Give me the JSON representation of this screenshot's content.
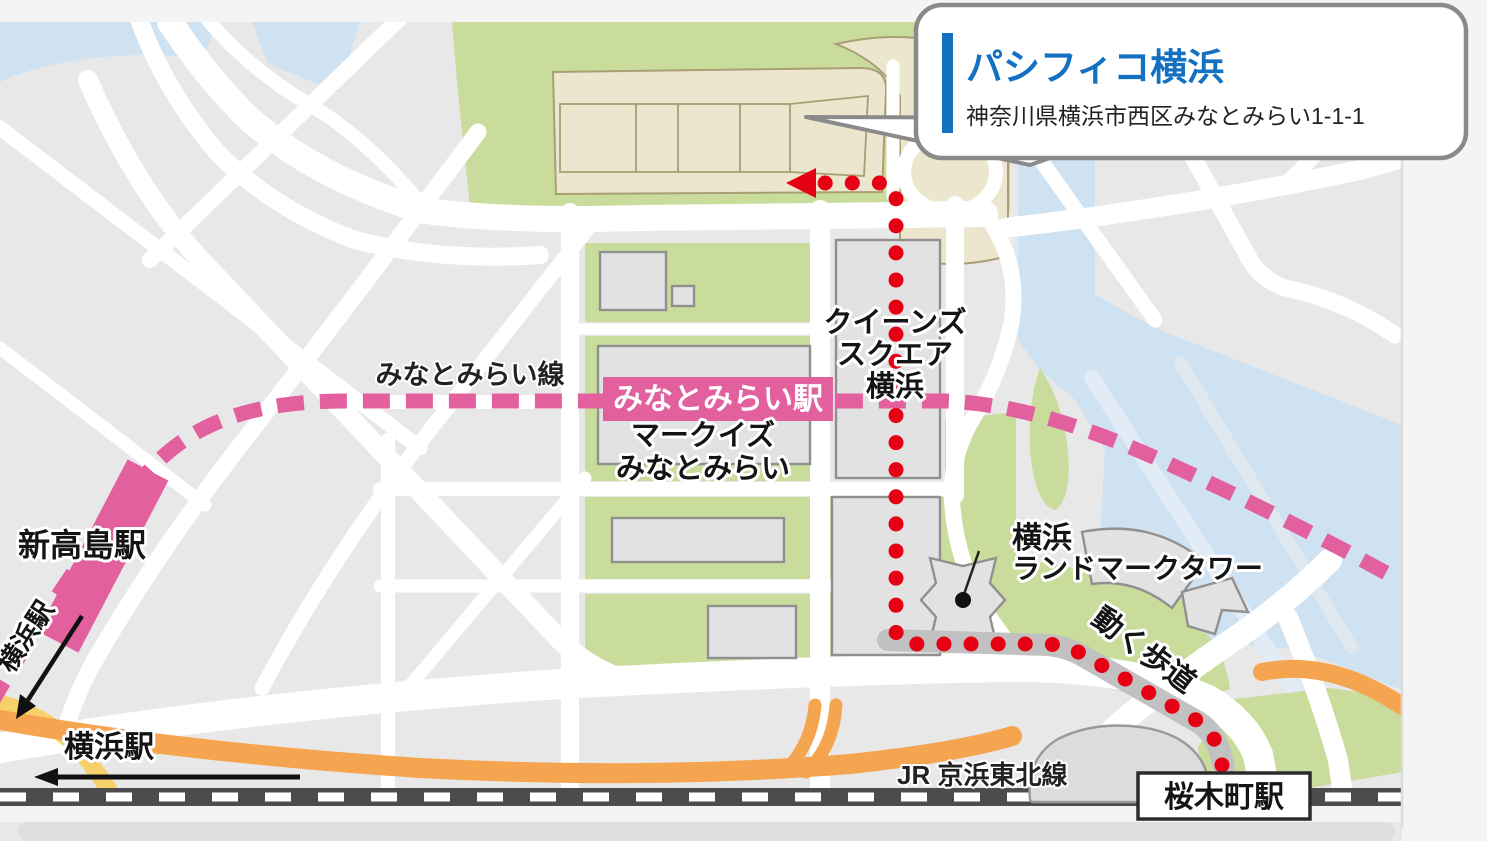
{
  "callout": {
    "title": "パシフィコ横浜",
    "address": "神奈川県横浜市西区みなとみらい1-1-1"
  },
  "stations": {
    "minatomirai": "みなとみらい駅",
    "shintakashima": "新高島駅",
    "sakuragicho": "桜木町駅"
  },
  "lines": {
    "minatomirai_line": "みなとみらい線",
    "jr_keihin_tohoku": "JR 京浜東北線"
  },
  "places": {
    "queens": [
      "クイーンズ",
      "スクエア",
      "横浜"
    ],
    "markis": [
      "マークイズ",
      "みなとみらい"
    ],
    "landmark": [
      "横浜",
      "ランドマークタワー"
    ],
    "walkway": "動く歩道"
  },
  "directions": {
    "yokohama_side": "横浜駅",
    "yokohama_bottom": "横浜駅"
  },
  "colors": {
    "minatomirai_pink": "#e2609e",
    "route_red": "#e60013",
    "accent_blue": "#1470c0",
    "highway_orange": "#f5a54f",
    "road_yellow": "#f7d06a",
    "park_green": "#cadc9c",
    "water_blue": "#cfe2f2",
    "building_beige": "#ece6cf"
  }
}
